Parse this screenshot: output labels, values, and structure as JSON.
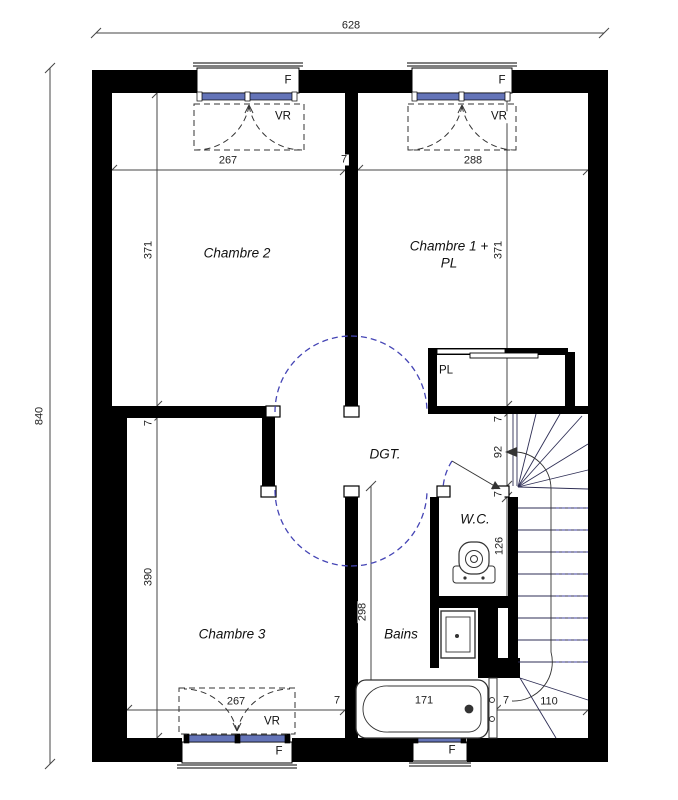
{
  "plan_type": "floor-plan-etage",
  "colors": {
    "wall": "#000000",
    "glazing": "#6474b8",
    "door_swing": "#4545b5",
    "linework": "#3d3d3d"
  },
  "overall": {
    "width_cm": "628",
    "height_cm": "840"
  },
  "rooms": {
    "chambre2": {
      "name": "Chambre 2",
      "width": "267",
      "height": "371"
    },
    "chambre1": {
      "name_line1": "Chambre 1 +",
      "name_line2": "PL",
      "width": "288",
      "height": "371"
    },
    "chambre3": {
      "name": "Chambre 3",
      "width": "267",
      "height": "390"
    },
    "degagement": {
      "name": "DGT."
    },
    "wc": {
      "name": "W.C.",
      "depth": "126"
    },
    "bains": {
      "name": "Bains",
      "height": "298",
      "tub_length": "171"
    },
    "placard": {
      "name": "PL"
    }
  },
  "dims": {
    "wall_thickness": "7",
    "stair_opening": "92",
    "stair_width": "110"
  },
  "windows": {
    "window_label": "F",
    "shutter_label": "VR"
  }
}
